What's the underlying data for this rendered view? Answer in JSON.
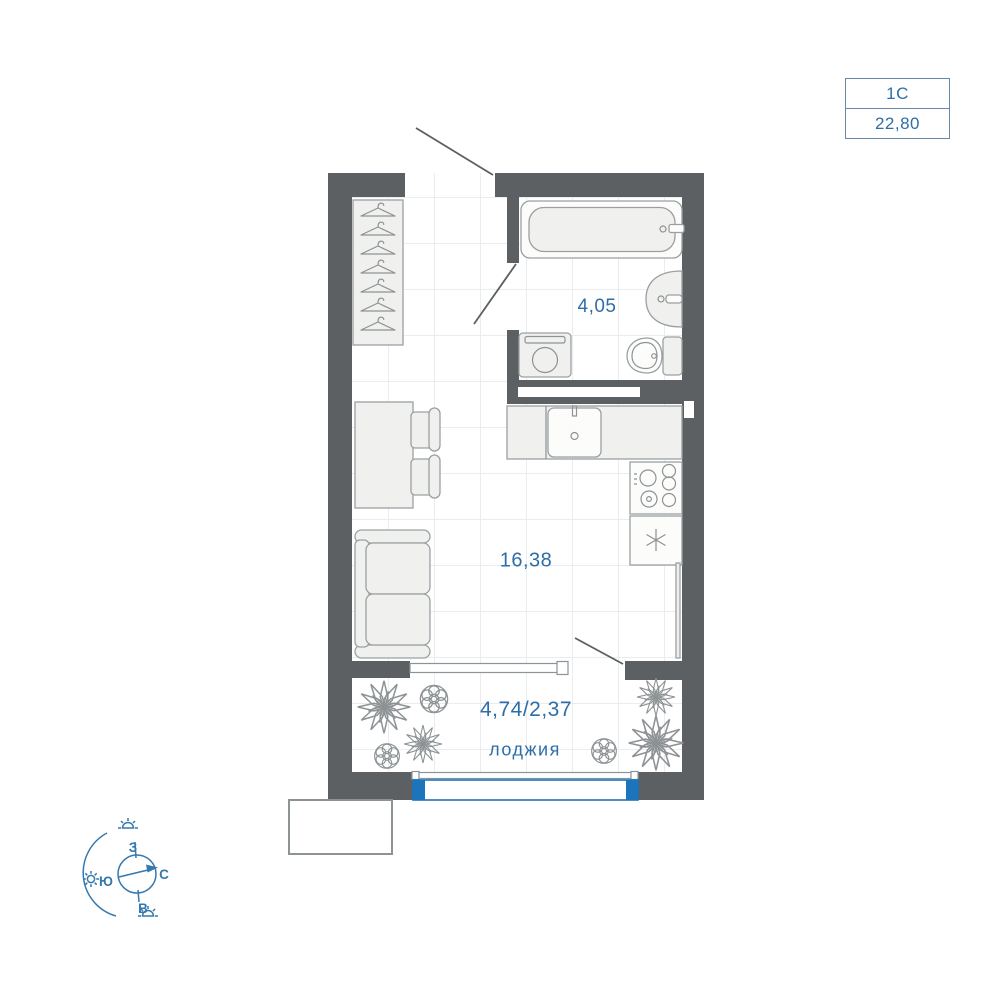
{
  "badge": {
    "plan_type": "1С",
    "area": "22,80"
  },
  "rooms": {
    "bathroom_area": "4,05",
    "main_area": "16,38",
    "loggia_area": "4,74/2,37",
    "loggia_label": "лоджия"
  },
  "compass": {
    "west": "З",
    "north": "С",
    "south": "Ю",
    "east": "В"
  },
  "colors": {
    "wall": "#5c6062",
    "accent_blue": "#2e6ea6",
    "window_blue": "#1c75bc",
    "grid": "#e9edef",
    "compass_blue": "#3579ae",
    "furniture_fill": "#f0f0ee",
    "furniture_stroke": "#9aa0a1"
  },
  "icons": {
    "hanger": "clothes-hanger-outline",
    "fridge_symbol": "snowflake-asterisk",
    "plant_spiky": "star-burst-plant",
    "plant_round": "round-bush",
    "sun": "sun-with-rays",
    "compass": "compass-rose-circle-arrow"
  }
}
